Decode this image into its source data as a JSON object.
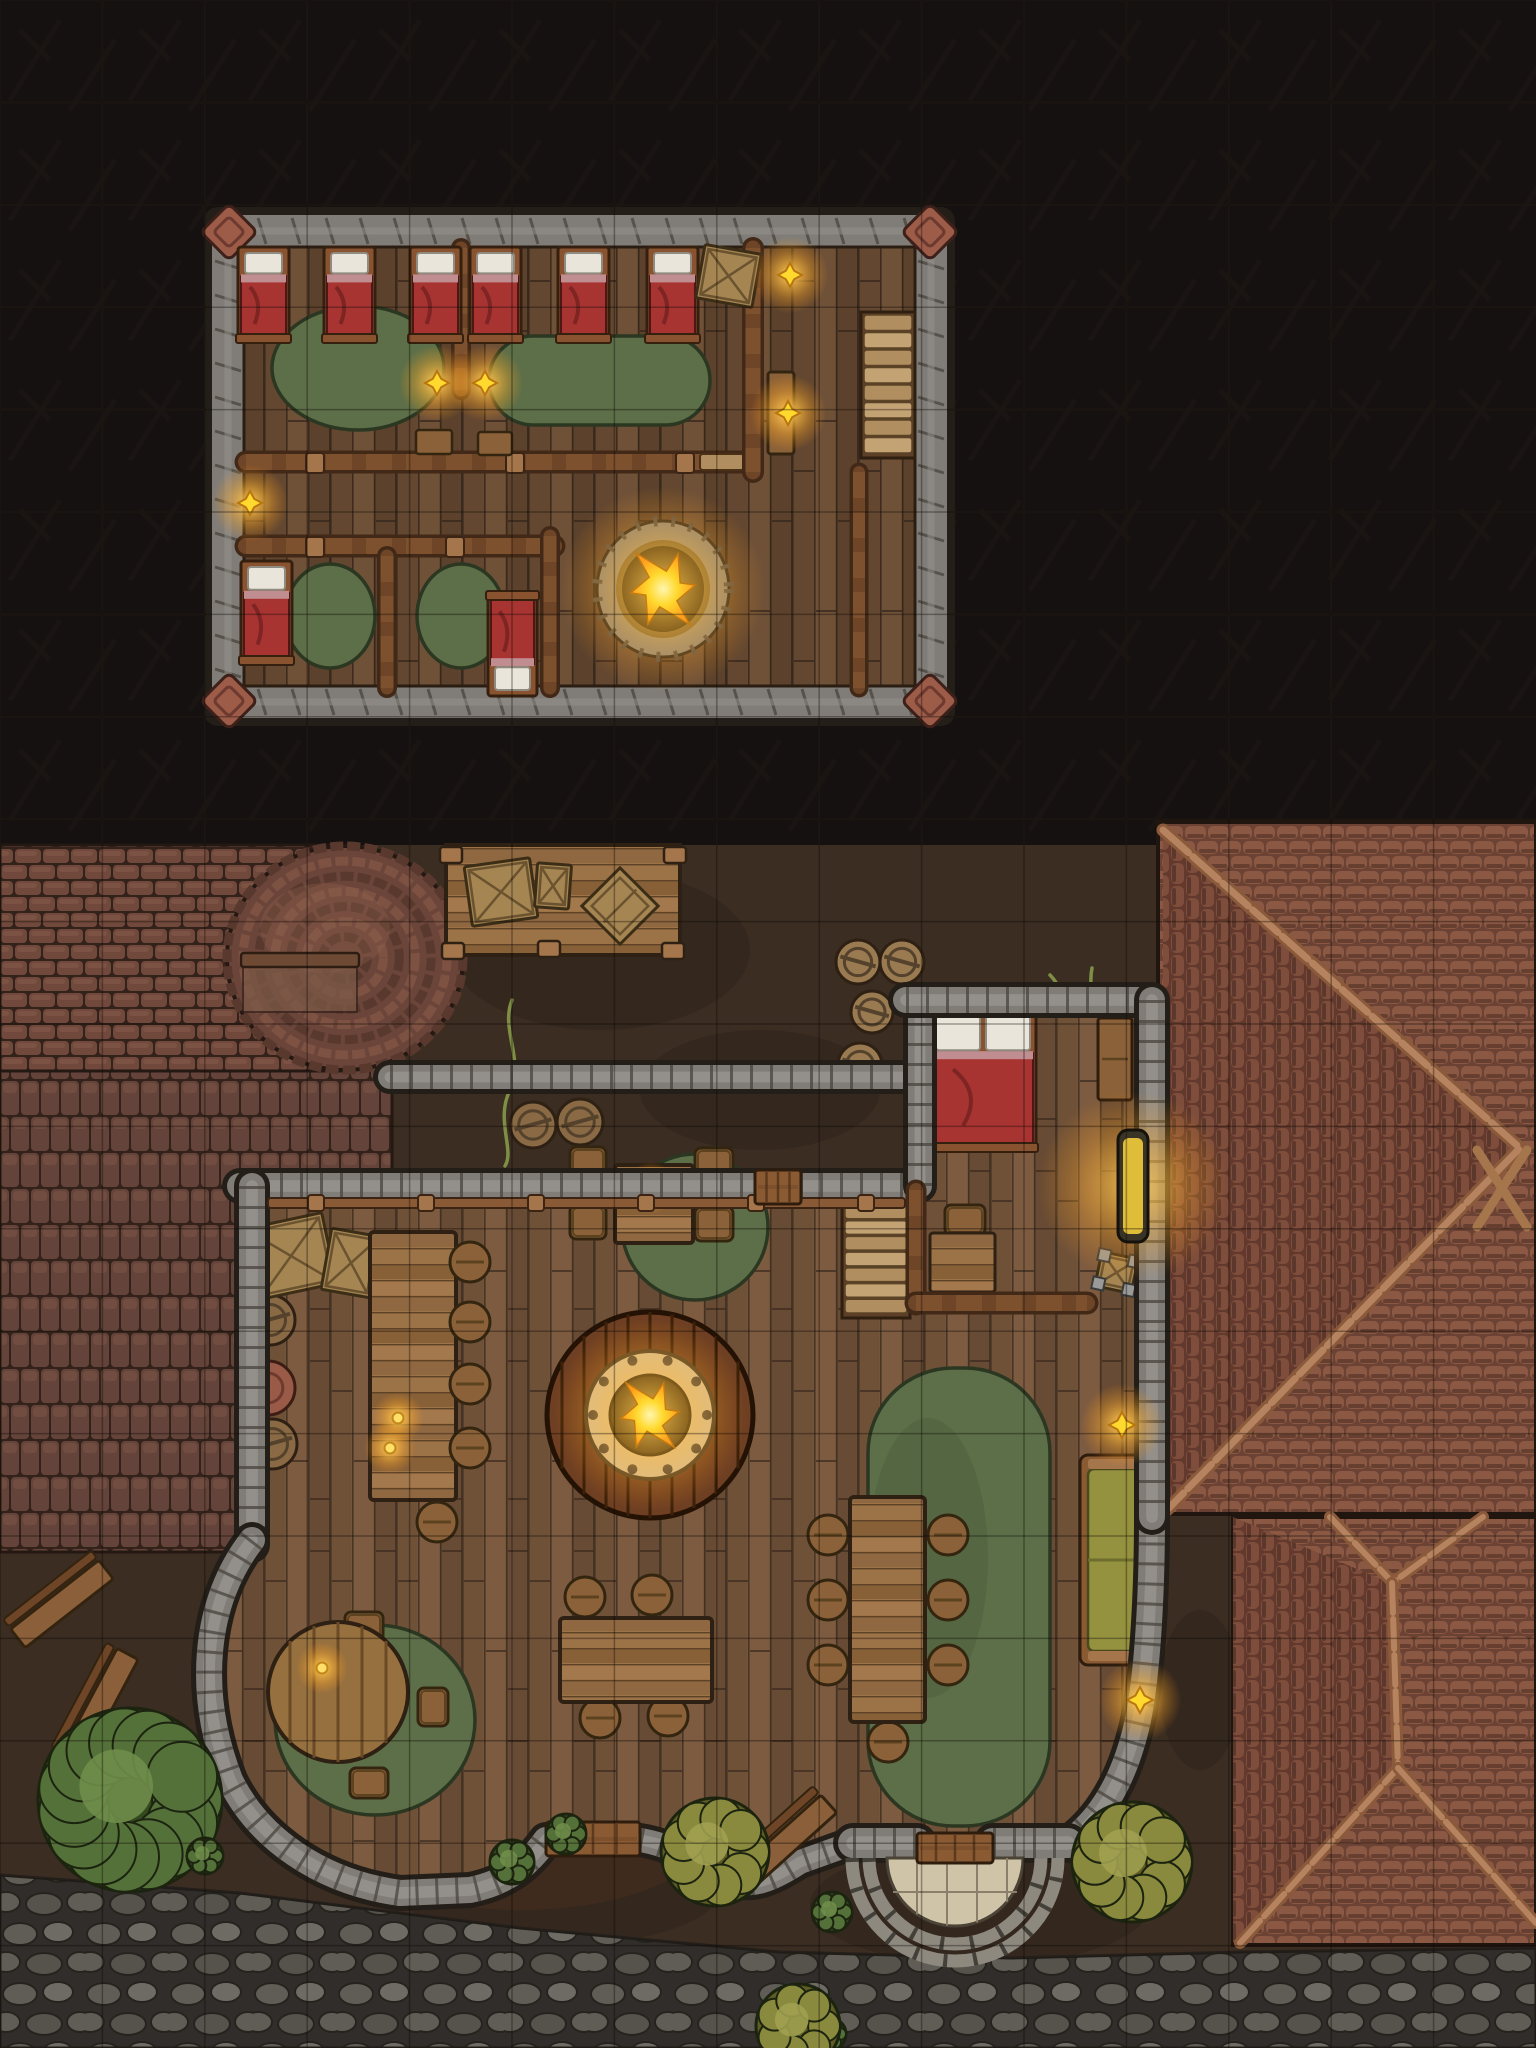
{
  "map": {
    "kind": "tavern-battle-map-top-down",
    "width": 1536,
    "height": 2048,
    "grid_step": 102.4,
    "floors": {
      "upper_floor_label": "upper-sleeping-floor",
      "ground_floor_label": "tavern-ground-floor"
    }
  },
  "palette": {
    "dark_bg": "#151110",
    "grid_light": "#241d17",
    "grid_dark": "#0d0805",
    "dirt": "#3b2d22",
    "dirt_dark": "#2c2119",
    "dirt_light": "#4c3a2b",
    "floor_base": "#75543c",
    "floor_dark": "#3a2a1e",
    "upper_floor_base": "#6d4e39",
    "stone_base": "#807d78",
    "stone_light": "#97948e",
    "stone_joint": "#4c4841",
    "stone_out": "#231e18",
    "wood_wall": "#6e4527",
    "wood_wall_dark": "#412817",
    "beam": "#8a5a36",
    "beam_light": "#a5764c",
    "table_wood": "#9c7247",
    "table_stripe": "#85603b",
    "bed_frame": "#8a5330",
    "bed_red": "#a83432",
    "bed_red_dark": "#7e2524",
    "pillow": "#e9e5da",
    "pillow_band": "#c08e90",
    "rug_green": "#5c6f48",
    "rug_green_dark": "#47583a",
    "rug_out": "#2c3722",
    "fire_ring": "#d8c49a",
    "fire_bolt": "#4a443c",
    "fire_pit": "#191409",
    "flame": "#ffd92e",
    "flame_core": "#fff6b0",
    "flame_glow": "#ff9d1f",
    "brick_base": "#64443a",
    "brick_light": "#8a5f4e",
    "brick_gap": "#33221a",
    "shingle_bg": "#6b4233",
    "shingle": "#8a5843",
    "shingle_dark": "#4e2f23",
    "cobble_bg": "#383430",
    "cobble": "#6e6a62",
    "cobble_light": "#7e7a72",
    "barrel": "#8a6a45",
    "barrel_band": "#54422c",
    "wicker": "#9a7a50",
    "crate": "#a58653",
    "crate_dark": "#6b5330",
    "couch": "#95923f",
    "couch_dark": "#6f6d2c",
    "bush_green": "#54713a",
    "bush_green_dark": "#35491f",
    "bush_olive": "#8a8a3e",
    "bush_olive_dark": "#5d5d24",
    "porch_tile": "#cfc3a8",
    "porch_line": "#8a7f6a",
    "glow": "#ffbf3a"
  },
  "legend": {
    "upper_floor": [
      "six-single-beds",
      "two-dorm-rugs",
      "chimney-hole-firepit",
      "stairs-down",
      "two-small-bedrooms",
      "wall-lamps",
      "storage-crate"
    ],
    "ground_floor": [
      "bar-counter-with-stools",
      "central-round-firepit",
      "square-table-4-chairs",
      "long-table-6-stools",
      "round-table-3-chairs",
      "bottom-table-4-stools",
      "bedroom-with-double-bed",
      "green-couch",
      "interior-stairs",
      "entry-door-with-round-porch",
      "side-door",
      "loading-platform-with-crates",
      "brick-kiln-dome",
      "barrels",
      "bushes",
      "cobblestone-street",
      "shingled-roofs"
    ]
  },
  "upper": {
    "building": {
      "x": 212,
      "y": 215,
      "w": 735,
      "h": 503,
      "wall": 32
    },
    "corners": [
      [
        229,
        232
      ],
      [
        930,
        232
      ],
      [
        229,
        701
      ],
      [
        930,
        701
      ]
    ],
    "beds_top": {
      "xs": [
        241,
        327,
        413,
        473,
        561,
        650
      ],
      "y": 250,
      "w": 45,
      "h": 88
    },
    "crate": {
      "x": 700,
      "y": 249,
      "w": 57,
      "h": 54,
      "rot": 10
    },
    "rug_left": {
      "cx": 358,
      "cy": 368,
      "rx": 86,
      "ry": 62
    },
    "rug_right": {
      "x": 489,
      "y": 336,
      "w": 221,
      "h": 89,
      "r": 44
    },
    "divider": {
      "x": 455,
      "y": 248,
      "w": 13,
      "h": 142
    },
    "wall_a": {
      "x": 246,
      "y": 452,
      "w": 500,
      "h": 20,
      "door_x": 700,
      "door_w": 44
    },
    "wall_b": {
      "x": 745,
      "y": 248,
      "w": 17,
      "h": 224
    },
    "sideboard": {
      "x": 768,
      "y": 372,
      "w": 26,
      "h": 82
    },
    "stairs": {
      "x": 864,
      "y": 315,
      "w": 48,
      "h": 140,
      "n": 8
    },
    "wall_c": {
      "x": 246,
      "y": 536,
      "w": 308,
      "h": 20
    },
    "wall_d": {
      "x": 380,
      "y": 556,
      "w": 14,
      "h": 132
    },
    "wall_e": {
      "x": 543,
      "y": 536,
      "w": 14,
      "h": 152
    },
    "wall_f": {
      "x": 853,
      "y": 472,
      "w": 13,
      "h": 216
    },
    "bed_small_left": {
      "x": 244,
      "y": 564,
      "w": 45,
      "h": 96
    },
    "bed_small_right": {
      "x": 491,
      "y": 597,
      "w": 43,
      "h": 96
    },
    "rug_small_left": {
      "cx": 330,
      "cy": 616,
      "rx": 45,
      "ry": 52
    },
    "rug_small_right": {
      "cx": 461,
      "cy": 616,
      "rx": 44,
      "ry": 52
    },
    "chimney_pit": {
      "cx": 663,
      "cy": 589,
      "rx": 54,
      "ry": 56
    },
    "benches": [
      {
        "x": 416,
        "y": 430,
        "w": 36,
        "h": 24
      },
      {
        "x": 478,
        "y": 432,
        "w": 34,
        "h": 23
      }
    ],
    "lamps": [
      [
        437,
        383
      ],
      [
        485,
        383
      ],
      [
        250,
        503
      ],
      [
        790,
        275
      ],
      [
        788,
        413
      ]
    ]
  },
  "ground": {
    "ground_top": 845,
    "cobbles_poly": "0,1875 240,1893 520,1928 780,1952 1010,1958 1240,1952 1536,1948 1536,2048 0,2048",
    "paving_poly": "0,1038 392,1038 392,1170 237,1170 237,1552 0,1552",
    "kiln": {
      "rect": {
        "x": 0,
        "y": 845,
        "w": 352,
        "h": 226
      },
      "dome": {
        "cx": 345,
        "cy": 958,
        "rx": 118,
        "ry": 112
      },
      "ledge": {
        "x": 241,
        "y": 953,
        "w": 118,
        "h": 14
      },
      "recess": {
        "x": 243,
        "y": 967,
        "w": 114,
        "h": 45
      }
    },
    "platform": {
      "x": 446,
      "y": 845,
      "w": 234,
      "h": 110
    },
    "platform_crates": [
      {
        "x": 468,
        "y": 862,
        "w": 66,
        "h": 60,
        "rot": -8
      },
      {
        "x": 536,
        "y": 864,
        "w": 34,
        "h": 44,
        "rot": 4
      }
    ],
    "diamond_crate": {
      "cx": 620,
      "cy": 906,
      "s": 54
    },
    "dirt_patches": [
      [
        600,
        950,
        150,
        80
      ],
      [
        760,
        1090,
        120,
        60
      ],
      [
        980,
        1905,
        170,
        60
      ],
      [
        560,
        1890,
        160,
        55
      ],
      [
        1200,
        1690,
        40,
        80
      ]
    ],
    "roof1": {
      "x": 1158,
      "y": 822,
      "w": 378,
      "h": 692,
      "ridge": [
        [
          1163,
          830
        ],
        [
          1520,
          1148
        ],
        [
          1167,
          1510
        ]
      ],
      "xcross": [
        [
          1477,
          1150,
          1527,
          1227
        ],
        [
          1527,
          1150,
          1477,
          1227
        ]
      ],
      "left_tri": "1163,830 1520,1148 1163,1510"
    },
    "roof2": {
      "x": 1233,
      "y": 1517,
      "w": 303,
      "h": 428,
      "beams": [
        [
          1330,
          1517,
          1395,
          1585
        ],
        [
          1483,
          1517,
          1392,
          1583
        ],
        [
          1392,
          1583,
          1398,
          1768
        ],
        [
          1240,
          1943,
          1398,
          1768
        ],
        [
          1398,
          1768,
          1536,
          1923
        ]
      ]
    },
    "tavern_floor": "268,1205 905,1205 905,1015 1140,1015 1150,1352 1152,1510 1148,1640 1125,1760 1070,1845 993,1857 917,1857 853,1845 800,1862 740,1885 690,1858 640,1840 546,1840 520,1855 470,1888 400,1893 310,1868 240,1800 205,1700 215,1610 268,1540",
    "walls": {
      "top": [
        [
          240,
          1186
        ],
        [
          908,
          1186
        ]
      ],
      "patio": [
        [
          390,
          1077
        ],
        [
          908,
          1077
        ]
      ],
      "left": [
        [
          252,
          1186
        ],
        [
          252,
          1545
        ]
      ],
      "bulge": "M252,1540 C205,1600 195,1690 230,1780 C258,1838 320,1882 400,1893 L470,1890 C510,1882 530,1862 546,1840",
      "right_of_door1": "M640,1840 C672,1845 700,1862 726,1878 C750,1890 772,1880 800,1862 L853,1843",
      "right_curve": "M1068,1843 C1100,1820 1125,1780 1138,1720 C1148,1670 1152,1590 1152,1515",
      "bedroom_left_stone": [
        [
          920,
          1186
        ],
        [
          920,
          1000
        ]
      ],
      "bedroom_top": [
        [
          906,
          1000
        ],
        [
          1150,
          1000
        ]
      ],
      "right": [
        [
          1152,
          1000
        ],
        [
          1152,
          1517
        ]
      ],
      "jamb1": {
        "x": 853,
        "y": 1828,
        "w": 64,
        "h": 30
      },
      "jamb2": {
        "x": 993,
        "y": 1828,
        "w": 75,
        "h": 30
      }
    },
    "wood_walls": {
      "bedroom_left": [
        [
          916,
          1190
        ],
        [
          916,
          1305
        ]
      ],
      "bedroom_bottom": [
        [
          916,
          1303
        ],
        [
          1087,
          1303
        ]
      ]
    },
    "top_door": {
      "x": 755,
      "y": 1170,
      "w": 46,
      "h": 34
    },
    "door1": {
      "x": 546,
      "y": 1822,
      "w": 94,
      "h": 34
    },
    "door2": {
      "x": 917,
      "y": 1833,
      "w": 76,
      "h": 30
    },
    "porch": {
      "cx": 955,
      "cy": 1858,
      "r_tiles": 68,
      "arcs": [
        86,
        103
      ]
    },
    "trim_top": {
      "x": 268,
      "y": 1198,
      "w": 637,
      "h": 10
    },
    "crates_inside": [
      {
        "x": 252,
        "y": 1220,
        "w": 78,
        "h": 72,
        "rot": -12
      },
      {
        "x": 326,
        "y": 1232,
        "w": 50,
        "h": 62,
        "rot": 10
      }
    ],
    "left_wall_items": {
      "barrels": [
        [
          270,
          1272,
          25
        ],
        [
          270,
          1320,
          25
        ],
        [
          272,
          1444,
          25
        ]
      ],
      "stump": [
        268,
        1388,
        27
      ]
    },
    "bar": {
      "x": 370,
      "y": 1232,
      "w": 86,
      "h": 268,
      "stools": [
        [
          470,
          1262
        ],
        [
          470,
          1322
        ],
        [
          470,
          1384
        ],
        [
          470,
          1448
        ]
      ],
      "stool_end": [
        437,
        1522
      ],
      "candles": [
        [
          398,
          1418
        ],
        [
          390,
          1448
        ]
      ]
    },
    "square_table": {
      "x": 615,
      "y": 1165,
      "w": 78,
      "h": 78,
      "candle": [
        651,
        1188
      ],
      "chairs": [
        [
          570,
          1147,
          36,
          34
        ],
        [
          570,
          1205,
          36,
          34
        ],
        [
          695,
          1148,
          38,
          34
        ],
        [
          695,
          1207,
          38,
          34
        ]
      ],
      "rug": {
        "cx": 695,
        "cy": 1227,
        "r": 73
      }
    },
    "firepit": {
      "cx": 650,
      "cy": 1415,
      "r_wood": 103,
      "r_ring": 64,
      "r_pit": 40
    },
    "stairs": {
      "x": 845,
      "y": 1205,
      "w": 62,
      "h": 110,
      "n": 7
    },
    "bedroom": {
      "bed": {
        "x": 933,
        "y": 1013,
        "w": 100,
        "h": 134
      },
      "dresser": {
        "x": 1098,
        "y": 1018,
        "w": 34,
        "h": 82
      },
      "lantern": {
        "x": 1118,
        "y": 1130,
        "w": 30,
        "h": 112
      },
      "desk": {
        "x": 930,
        "y": 1233,
        "w": 65,
        "h": 59
      },
      "desk_chair": {
        "x": 945,
        "y": 1205,
        "w": 40,
        "h": 30
      },
      "crate_small": {
        "x": 1098,
        "y": 1255,
        "w": 37,
        "h": 35,
        "rot": 12
      }
    },
    "star_lamps": [
      [
        1122,
        1425
      ],
      [
        1140,
        1700
      ]
    ],
    "couch": {
      "x": 1080,
      "y": 1455,
      "w": 68,
      "h": 210
    },
    "long_table": {
      "x": 850,
      "y": 1497,
      "w": 75,
      "h": 225,
      "rug": {
        "x": 868,
        "y": 1368,
        "w": 182,
        "h": 458,
        "r": 85
      },
      "stools": [
        [
          828,
          1535
        ],
        [
          828,
          1600
        ],
        [
          828,
          1665
        ],
        [
          948,
          1535
        ],
        [
          948,
          1600
        ],
        [
          948,
          1665
        ],
        [
          888,
          1742
        ]
      ]
    },
    "bottom_table": {
      "x": 560,
      "y": 1618,
      "w": 152,
      "h": 84,
      "stools": [
        [
          585,
          1597
        ],
        [
          652,
          1595
        ],
        [
          600,
          1718
        ],
        [
          668,
          1716
        ]
      ]
    },
    "round_table": {
      "cx": 338,
      "cy": 1692,
      "r": 70,
      "candle": [
        322,
        1668
      ],
      "chairs": [
        [
          345,
          1612,
          38,
          30
        ],
        [
          418,
          1688,
          30,
          38
        ],
        [
          350,
          1768,
          38,
          30
        ]
      ],
      "rug": {
        "cx": 375,
        "cy": 1720,
        "rx": 100,
        "ry": 95
      }
    },
    "outdoor_benches": [
      {
        "cx": 62,
        "cy": 1604,
        "len": 112,
        "rot": -38
      },
      {
        "cx": 100,
        "cy": 1706,
        "len": 118,
        "rot": -62
      },
      {
        "cx": 782,
        "cy": 1846,
        "len": 126,
        "rot": -42
      }
    ],
    "bushes": [
      {
        "cx": 130,
        "cy": 1800,
        "r": 92,
        "kind": "green"
      },
      {
        "cx": 205,
        "cy": 1856,
        "r": 18,
        "kind": "tuft"
      },
      {
        "cx": 512,
        "cy": 1862,
        "r": 22,
        "kind": "tuft"
      },
      {
        "cx": 566,
        "cy": 1834,
        "r": 20,
        "kind": "tuft"
      },
      {
        "cx": 832,
        "cy": 1912,
        "r": 20,
        "kind": "tuft"
      },
      {
        "cx": 830,
        "cy": 2034,
        "r": 16,
        "kind": "tuft"
      },
      {
        "cx": 715,
        "cy": 1852,
        "r": 54,
        "kind": "olive"
      },
      {
        "cx": 1132,
        "cy": 1862,
        "r": 60,
        "kind": "olive"
      },
      {
        "cx": 798,
        "cy": 2026,
        "r": 42,
        "kind": "olive"
      }
    ],
    "dirt_barrels": [
      [
        533,
        1125,
        23
      ],
      [
        580,
        1122,
        23
      ]
    ],
    "wicker_barrels": [
      [
        858,
        962,
        22
      ],
      [
        902,
        962,
        22
      ],
      [
        872,
        1012,
        21
      ],
      [
        860,
        1065,
        22
      ]
    ],
    "vines": [
      "M512,1000 C500,1030 525,1060 510,1090 C495,1120 515,1150 505,1166",
      "M1050,975 C1070,995 1058,1020 1080,1042 M1092,968 C1086,998 1106,1022 1096,1048"
    ]
  }
}
